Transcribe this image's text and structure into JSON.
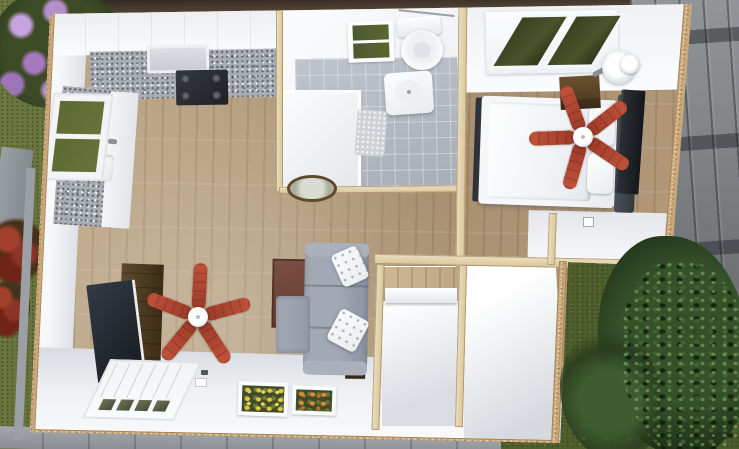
{
  "scene": {
    "title": "Aerial 3D cutaway rendering of a small one-bedroom house floor plan with surrounding yard",
    "view": "top-down cutaway",
    "style": "photorealistic 3D floor plan render",
    "text_content": "none — image contains no visible text"
  },
  "house": {
    "rooms": [
      {
        "name": "kitchen",
        "position": "top-left",
        "items": [
          "white-upper-cabinets",
          "range-hood",
          "four-burner-stove",
          "granite-l-counter",
          "double-basin-sink",
          "garden-window"
        ]
      },
      {
        "name": "bathroom",
        "position": "top-center",
        "items": [
          "toilet",
          "towel-bar",
          "wall-sink",
          "shower-enclosure",
          "bath-mat",
          "window",
          "gray-tile-floor"
        ]
      },
      {
        "name": "bedroom",
        "position": "top-right",
        "items": [
          "double-bed-white-duvet",
          "two-pillows",
          "dark-headboard",
          "wood-nightstand",
          "round-table-lamp",
          "red-ceiling-fan",
          "wall-mounted-tv",
          "wall-sconce",
          "double-window"
        ]
      },
      {
        "name": "living-room",
        "position": "bottom-left",
        "items": [
          "flat-screen-tv",
          "dark-media-console",
          "red-ceiling-fan",
          "gray-l-shaped-sofa",
          "two-white-tufted-pillows",
          "brown-area-rug",
          "dark-bookshelf",
          "round-ceiling-light"
        ]
      },
      {
        "name": "hallway-and-closets",
        "position": "bottom-center",
        "items": [
          "closet-with-shelf",
          "empty-closet-room",
          "wood-capped-stud-walls"
        ]
      }
    ],
    "entry_wall": {
      "items": [
        "white-panel-door-with-four-glass-panes",
        "window-with-yellow-flower-box",
        "window-with-orange-flower-box",
        "light-switch"
      ]
    },
    "flooring": [
      "light-oak-plank",
      "gray-ceramic-tile"
    ]
  },
  "exterior": {
    "items": [
      "green-lawn",
      "purple-lilac-shrub",
      "red-flower-bushes",
      "stone-path",
      "concrete-walkway",
      "gray-plank-fence",
      "large-green-bush",
      "yellow-wildflowers",
      "osb-cut-wall-edges",
      "lumber-top-plates"
    ]
  },
  "palette": {
    "fan_blade_red": "#b0452f",
    "wood_floor": "#b49b7d",
    "granite_counter": "#a9aeb5",
    "cabinet_white": "#f4f5f7",
    "stove_black": "#2d3136",
    "sofa_gray": "#9aa1ae",
    "pillow_white": "#f5f5f7",
    "rug_brown": "#6e4a3d",
    "console_brown": "#53422a",
    "tv_screen": "#22262b",
    "bed_white": "#f2f3f6",
    "headboard_gray": "#474c54",
    "nightstand_brown": "#5d482c",
    "tile_gray": "#b5bbc3",
    "grass_green": "#5f6e35",
    "lilac_purple": "#b48fca",
    "red_flowers": "#8a3326",
    "fence_gray": "#84888c",
    "bush_green": "#2c4523",
    "osb_tan": "#c9a87b",
    "top_plate_wood": "#dccba4",
    "wall_white": "#eef0f3",
    "pavement_gray": "#94989c",
    "flowers_yellow": "#e5c53f",
    "flowers_orange": "#d98c33",
    "window_foliage_green": "#49542c"
  }
}
